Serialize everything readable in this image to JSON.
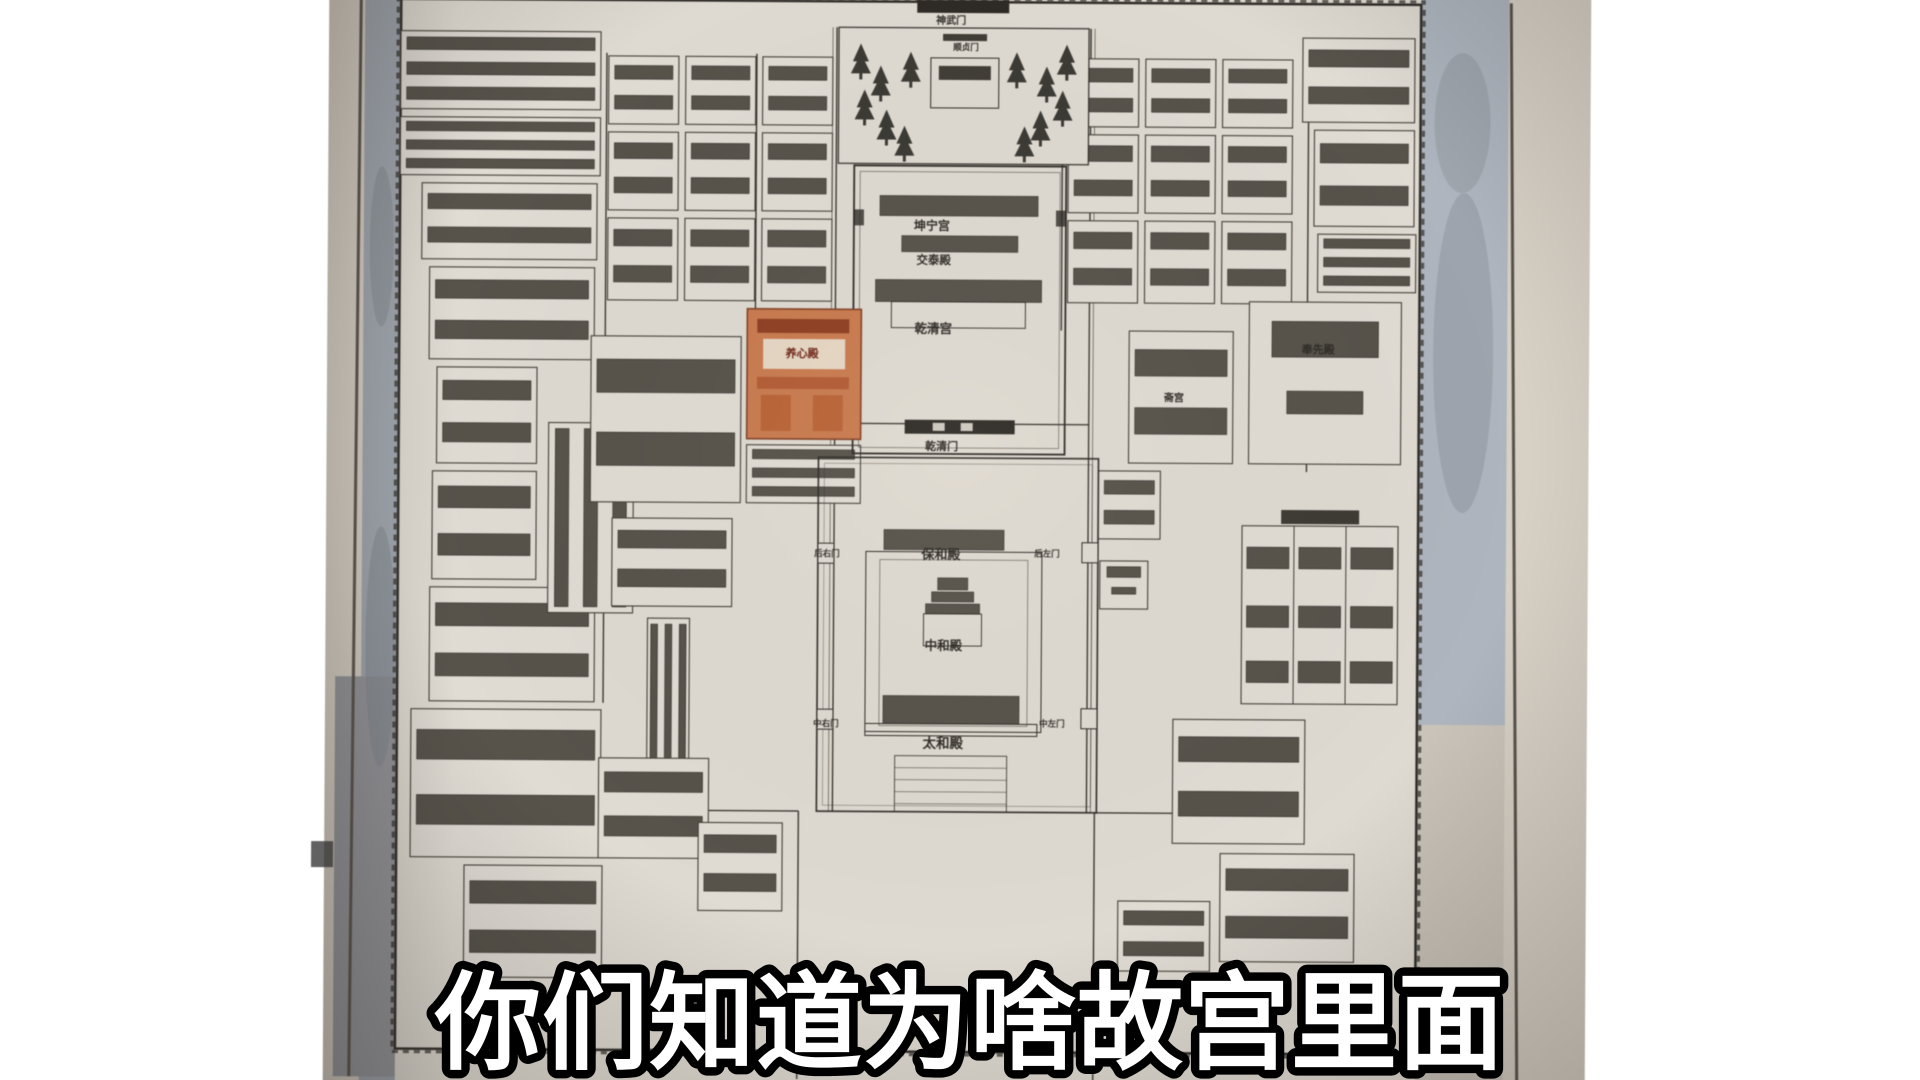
{
  "subtitle": {
    "text": "你们知道为啥故宫里面"
  },
  "map": {
    "title": "故宫平面图",
    "labels": {
      "shenwumen": "神武门",
      "shunzhenmen": "顺贞门",
      "kunning": "坤宁宫",
      "jiaotai": "交泰殿",
      "qianqing": "乾清宫",
      "yangxin": "养心殿",
      "qianqingmen": "乾清门",
      "houyoumen": "后右门",
      "baohe": "保和殿",
      "houzuomen": "后左门",
      "zhonghe": "中和殿",
      "zhongyoumen": "中右门",
      "taihe": "太和殿",
      "zhongzuomen": "中左门",
      "zhaigong": "斋宫",
      "fengxian": "奉先殿"
    },
    "highlighted_hall": "养心殿",
    "compounds": [
      [
        398,
        34,
        200,
        78,
        "r3"
      ],
      [
        398,
        120,
        200,
        58,
        "r3"
      ],
      [
        420,
        186,
        175,
        76,
        "c2"
      ],
      [
        428,
        270,
        165,
        92,
        "c2"
      ],
      [
        436,
        370,
        100,
        96,
        "c2"
      ],
      [
        432,
        474,
        104,
        108,
        "c2"
      ],
      [
        430,
        590,
        165,
        114,
        "c2"
      ],
      [
        412,
        712,
        190,
        148,
        "c2"
      ],
      [
        466,
        868,
        138,
        112,
        "c2"
      ],
      [
        548,
        425,
        85,
        190,
        "v3"
      ],
      [
        590,
        338,
        150,
        166,
        "c2"
      ],
      [
        612,
        520,
        120,
        88,
        "c2"
      ],
      [
        648,
        620,
        42,
        160,
        "v3"
      ],
      [
        600,
        760,
        110,
        100,
        "c2"
      ],
      [
        746,
        446,
        114,
        58,
        "r3"
      ],
      [
        700,
        824,
        84,
        88,
        "c2"
      ],
      [
        606,
        58,
        70,
        68,
        "c2"
      ],
      [
        683,
        58,
        70,
        68,
        "c2"
      ],
      [
        760,
        58,
        70,
        68,
        "c2"
      ],
      [
        606,
        134,
        70,
        78,
        "c2"
      ],
      [
        683,
        134,
        70,
        78,
        "c2"
      ],
      [
        760,
        134,
        70,
        78,
        "c2"
      ],
      [
        606,
        220,
        70,
        82,
        "c2"
      ],
      [
        683,
        220,
        70,
        82,
        "c2"
      ],
      [
        760,
        220,
        70,
        82,
        "c2"
      ],
      [
        1066,
        58,
        70,
        68,
        "c2"
      ],
      [
        1143,
        58,
        70,
        68,
        "c2"
      ],
      [
        1220,
        58,
        70,
        68,
        "c2"
      ],
      [
        1066,
        134,
        70,
        78,
        "c2"
      ],
      [
        1143,
        134,
        70,
        78,
        "c2"
      ],
      [
        1220,
        134,
        70,
        78,
        "c2"
      ],
      [
        1066,
        220,
        70,
        82,
        "c2"
      ],
      [
        1143,
        220,
        70,
        82,
        "c2"
      ],
      [
        1220,
        220,
        70,
        82,
        "c2"
      ],
      [
        1300,
        36,
        112,
        84,
        "c2"
      ],
      [
        1312,
        128,
        100,
        96,
        "c2"
      ],
      [
        1316,
        232,
        98,
        58,
        "r3"
      ],
      [
        1248,
        300,
        152,
        162,
        "hall"
      ],
      [
        1128,
        330,
        104,
        132,
        "c2"
      ],
      [
        1098,
        470,
        62,
        68,
        "c2"
      ],
      [
        1242,
        524,
        156,
        178,
        "grid"
      ],
      [
        1100,
        560,
        48,
        48,
        "hall"
      ],
      [
        1174,
        718,
        132,
        124,
        "c2"
      ],
      [
        1222,
        852,
        134,
        108,
        "c2"
      ],
      [
        1120,
        900,
        92,
        70,
        "c2"
      ]
    ],
    "trees": [
      [
        858,
        70
      ],
      [
        878,
        92
      ],
      [
        862,
        116
      ],
      [
        884,
        136
      ],
      [
        902,
        152
      ],
      [
        1064,
        70
      ],
      [
        1044,
        92
      ],
      [
        1060,
        116
      ],
      [
        1038,
        136
      ],
      [
        1022,
        152
      ],
      [
        908,
        78
      ],
      [
        1014,
        78
      ]
    ]
  },
  "colors": {
    "page_bg": "#ffffff",
    "photo_margin": "#d7d0c5",
    "map_paper": "#dfdad1",
    "moat_gray_blue": "#9fa6ae",
    "ink": "#2e2b27",
    "highlight_orange": "#c97a4e",
    "subtitle_fill": "#ffffff",
    "subtitle_stroke": "#000000"
  }
}
